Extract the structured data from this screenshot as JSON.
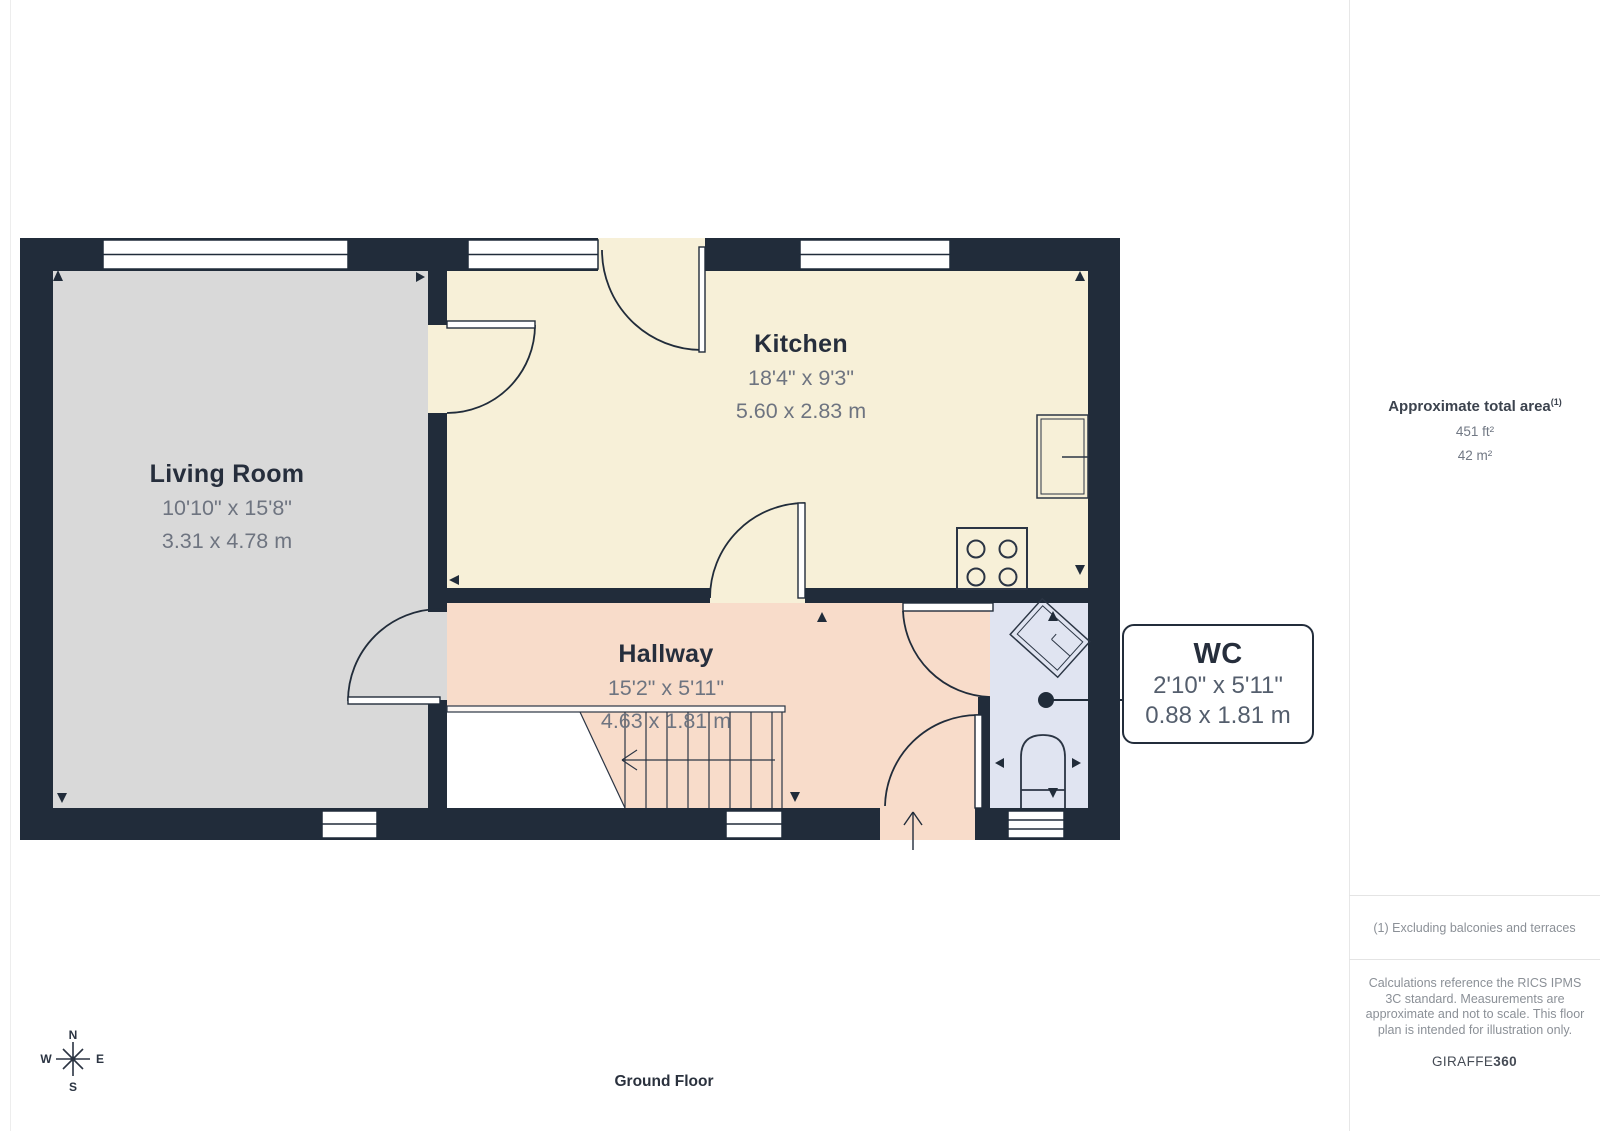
{
  "rooms": [
    {
      "name": "Living Room",
      "imperial": "10'10\" x 15'8\"",
      "metric": "3.31 x 4.78 m"
    },
    {
      "name": "Kitchen",
      "imperial": "18'4\" x 9'3\"",
      "metric": "5.60 x 2.83 m"
    },
    {
      "name": "Hallway",
      "imperial": "15'2\" x 5'11\"",
      "metric": "4.63 x 1.81 m"
    },
    {
      "name": "WC",
      "imperial": "2'10\" x 5'11\"",
      "metric": "0.88 x 1.81 m"
    }
  ],
  "sidebar": {
    "area_title": "Approximate total area",
    "area_superscript": "(1)",
    "area_ft": "451 ft²",
    "area_m": "42 m²",
    "footnote": "(1) Excluding balconies and terraces",
    "disclaimer": "Calculations reference the RICS IPMS 3C standard. Measurements are approximate and not to scale. This floor plan is intended for illustration only.",
    "brand_regular": "GIRAFFE",
    "brand_bold": "360"
  },
  "floor_label": "Ground Floor",
  "compass": {
    "north": "N",
    "south": "S",
    "east": "E",
    "west": "W"
  },
  "colors": {
    "wall": "#212c3a",
    "living_room_floor": "#d9d9d9",
    "kitchen_floor": "#f7f0d8",
    "hallway_floor": "#f8dcca",
    "wc_floor": "#e0e4f1",
    "line": "#2b3544"
  }
}
